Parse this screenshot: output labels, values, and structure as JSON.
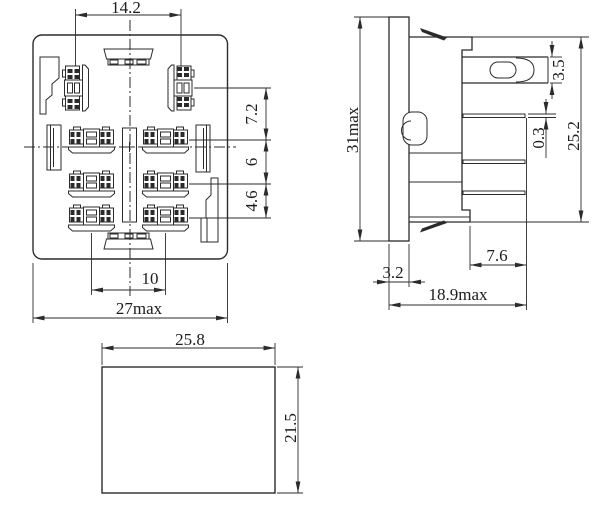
{
  "drawing": {
    "type": "engineering-dimension-drawing",
    "background": "#ffffff",
    "line_color": "#2b2b2b",
    "views": {
      "front_view": {
        "dims": {
          "top_span": "14.2",
          "row_gap_1": "7.2",
          "row_gap_2": "6",
          "row_gap_3": "4.6",
          "bottom_span": "10",
          "overall_width": "27max"
        }
      },
      "side_view": {
        "dims": {
          "overall_height": "31max",
          "blade_width": "3.5",
          "pin_thickness": "0.3",
          "body_height": "25.2",
          "flange_thickness": "3.2",
          "pin_length": "7.6",
          "overall_depth": "18.9max"
        }
      },
      "top_view": {
        "dims": {
          "width": "25.8",
          "height": "21.5"
        }
      }
    }
  }
}
